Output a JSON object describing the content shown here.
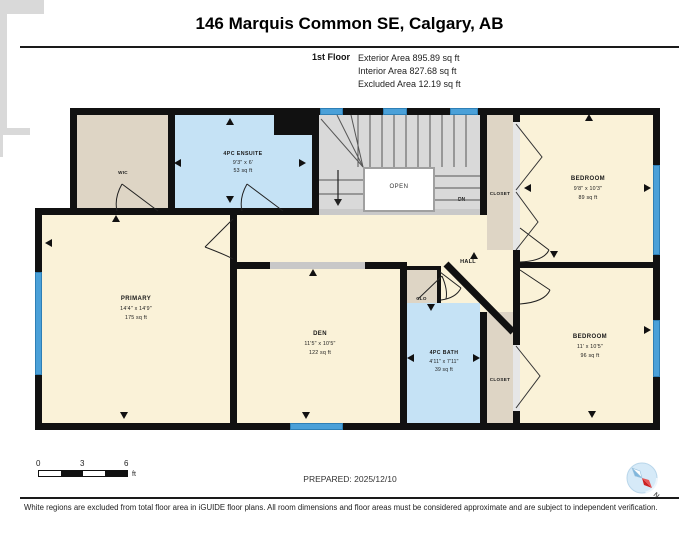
{
  "header": {
    "title": "146 Marquis Common SE, Calgary, AB",
    "floor_label": "1st Floor",
    "area_lines": [
      "Exterior Area 895.89 sq ft",
      "Interior Area 827.68 sq ft",
      "Excluded Area 12.19 sq ft"
    ]
  },
  "rooms": {
    "wic": {
      "name": "WIC"
    },
    "ensuite": {
      "name": "4PC ENSUITE",
      "dims": "9'3\" x 6'",
      "area": "53 sq ft"
    },
    "stairs": {
      "open": "OPEN",
      "down": "DN"
    },
    "closet_top": {
      "name": "CLOSET"
    },
    "bedroom_top": {
      "name": "BEDROOM",
      "dims": "9'8\" x 10'3\"",
      "area": "89 sq ft"
    },
    "hall": {
      "name": "HALL"
    },
    "clo": {
      "name": "CLO"
    },
    "primary": {
      "name": "PRIMARY",
      "dims": "14'4\" x 14'9\"",
      "area": "175 sq ft"
    },
    "den": {
      "name": "DEN",
      "dims": "11'5\" x 10'5\"",
      "area": "122 sq ft"
    },
    "bath": {
      "name": "4PC BATH",
      "dims": "4'11\" x 7'11\"",
      "area": "39 sq ft"
    },
    "closet_bottom": {
      "name": "CLOSET"
    },
    "bedroom_bottom": {
      "name": "BEDROOM",
      "dims": "11' x 10'5\"",
      "area": "96 sq ft"
    }
  },
  "scale_bar": {
    "ticks": [
      "0",
      "3",
      "6"
    ],
    "unit": "ft"
  },
  "footer": {
    "prepared": "PREPARED: 2025/12/10",
    "disclaimer": "White regions are excluded from total floor area in iGUIDE floor plans. All room dimensions and floor areas must be considered approximate and are subject to independent verification.",
    "compass_label": "N"
  },
  "colors": {
    "room_fill": "#FAF2D8",
    "closet_fill": "#DED5C5",
    "bath_fill": "#C5E2F5",
    "stairs_fill": "#D9D9D9",
    "wall": "#111111",
    "window": "#4AA0D8",
    "compass_needle": "#CC2222"
  }
}
